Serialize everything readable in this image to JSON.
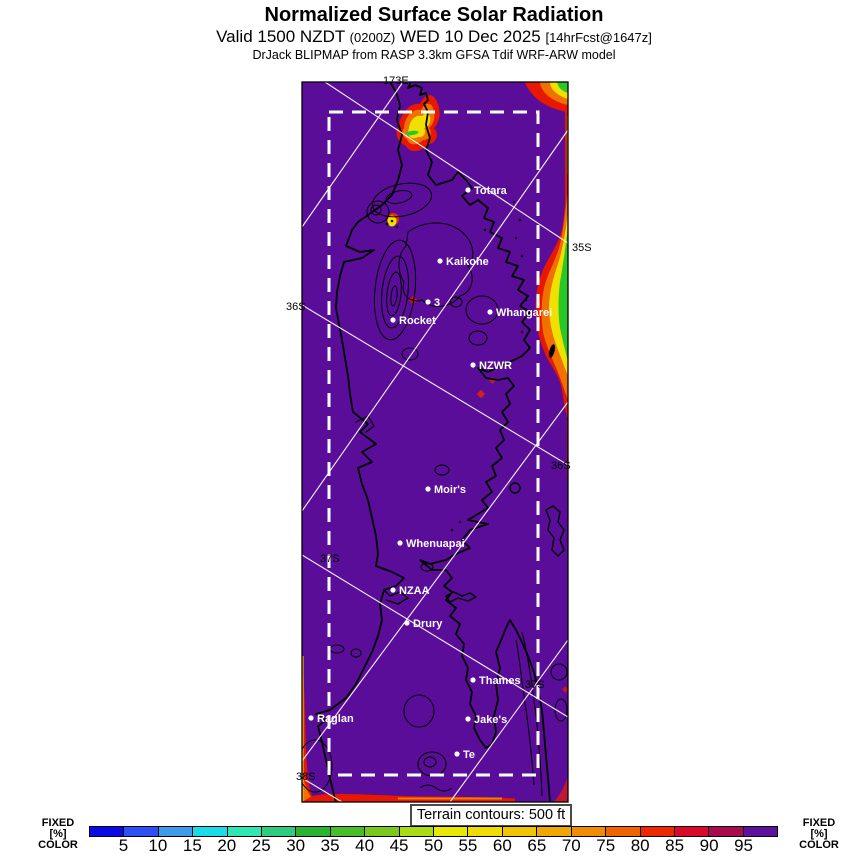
{
  "header": {
    "title": "Normalized Surface Solar Radiation",
    "valid_prefix": "Valid 1500 NZDT",
    "valid_zulu": "(0200Z)",
    "valid_date": "WED 10 Dec 2025",
    "forecast_tag": "[14hrFcst@1647z]",
    "model_line": "DrJack BLIPMAP from RASP 3.3km GFSA Tdif WRF-ARW model"
  },
  "map": {
    "terrain_note": "Terrain contours: 500 ft",
    "colors": {
      "background": "#5a0d99",
      "coastline": "#000000",
      "graticule": "#ffffff",
      "domain_border": "#ffffff",
      "hotspot_red": "#e81800",
      "hotspot_orange": "#f07000",
      "hotspot_yellow": "#f0e000",
      "hotspot_green": "#28c828"
    },
    "grid_labels": [
      {
        "text": "173E",
        "x": 113,
        "y": 14
      },
      {
        "text": "35S",
        "x": 302,
        "y": 181
      },
      {
        "text": "36S",
        "x": 16,
        "y": 240
      },
      {
        "text": "36S",
        "x": 281,
        "y": 399
      },
      {
        "text": "37S",
        "x": 50,
        "y": 492
      },
      {
        "text": "37S",
        "x": 255,
        "y": 618
      },
      {
        "text": "38S",
        "x": 26,
        "y": 710
      }
    ],
    "stations": [
      {
        "name": "Totara",
        "x": 198,
        "y": 120
      },
      {
        "name": "Kaikohe",
        "x": 170,
        "y": 191
      },
      {
        "name": "3",
        "x": 158,
        "y": 232
      },
      {
        "name": "Whangarei",
        "x": 220,
        "y": 242
      },
      {
        "name": "Rocket",
        "x": 123,
        "y": 250
      },
      {
        "name": "NZWR",
        "x": 203,
        "y": 295
      },
      {
        "name": "Moir's",
        "x": 158,
        "y": 419
      },
      {
        "name": "Whenuapai",
        "x": 130,
        "y": 473
      },
      {
        "name": "NZAA",
        "x": 123,
        "y": 520
      },
      {
        "name": "Drury",
        "x": 137,
        "y": 553
      },
      {
        "name": "Thames",
        "x": 203,
        "y": 610
      },
      {
        "name": "Raglan",
        "x": 41,
        "y": 648
      },
      {
        "name": "Jake's",
        "x": 198,
        "y": 649
      },
      {
        "name": "Te",
        "x": 187,
        "y": 684
      }
    ]
  },
  "colorbar": {
    "units_label_lines": [
      "FIXED",
      "[%]",
      "COLOR"
    ],
    "ticks": [
      5,
      10,
      15,
      20,
      25,
      30,
      35,
      40,
      45,
      50,
      55,
      60,
      65,
      70,
      75,
      80,
      85,
      90,
      95
    ],
    "segment_colors": [
      "#0a0ae8",
      "#2b50f5",
      "#3f9be8",
      "#18dce8",
      "#2ee8b4",
      "#2ecc7f",
      "#28b42e",
      "#46be28",
      "#78c81e",
      "#aadc14",
      "#e8e800",
      "#f0dc00",
      "#f0c400",
      "#f0a800",
      "#f08c00",
      "#f06400",
      "#f02800",
      "#dc0a28",
      "#aa0a50",
      "#5e109e"
    ]
  },
  "chart_data": {
    "type": "heatmap",
    "title": "Normalized Surface Solar Radiation",
    "units": "%",
    "scale_ticks": [
      5,
      10,
      15,
      20,
      25,
      30,
      35,
      40,
      45,
      50,
      55,
      60,
      65,
      70,
      75,
      80,
      85,
      90,
      95
    ],
    "scale_colors": [
      "#0a0ae8",
      "#2b50f5",
      "#3f9be8",
      "#18dce8",
      "#2ee8b4",
      "#2ecc7f",
      "#28b42e",
      "#46be28",
      "#78c81e",
      "#aadc14",
      "#e8e800",
      "#f0dc00",
      "#f0c400",
      "#f0a800",
      "#f08c00",
      "#f06400",
      "#f02800",
      "#dc0a28",
      "#aa0a50",
      "#5e109e"
    ],
    "legend_note": "map mostly >95% (purple) with low-radiation hotspots near Cape Reinga, east of Whangarei, and along SW/bottom domain edges"
  }
}
